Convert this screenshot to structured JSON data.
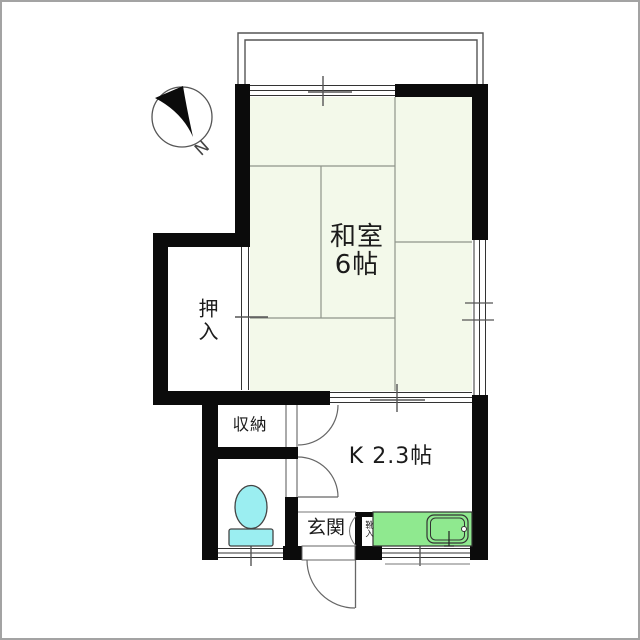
{
  "colors": {
    "wall": "#0b0b0b",
    "tatami": "#f3f9ea",
    "toilet": "#9beef1",
    "sink": "#8fe98f"
  },
  "compass": {
    "north_label": "N"
  },
  "rooms": {
    "washitsu": {
      "label": "和室\n6帖"
    },
    "oshiire": {
      "label": "押入"
    },
    "shuunou": {
      "label": "収納"
    },
    "kitchen": {
      "label": "K 2.3帖"
    },
    "genkan": {
      "label": "玄関"
    },
    "kutsuire": {
      "label": "靴入"
    }
  }
}
